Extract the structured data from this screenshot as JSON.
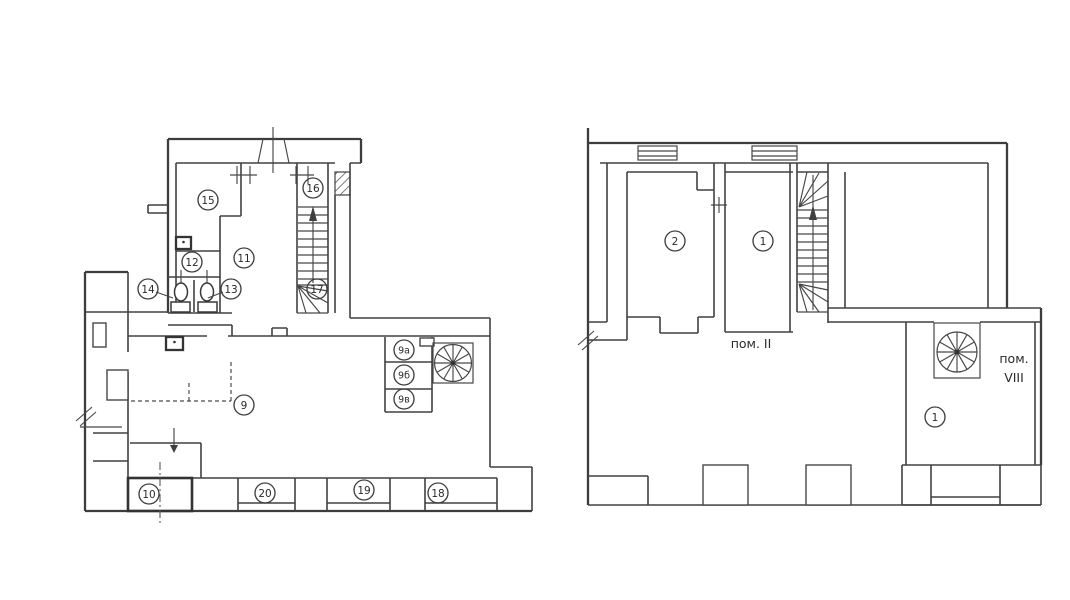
{
  "canvas": {
    "background": "#ffffff",
    "line_color": "#3f3f3f",
    "text_color": "#2b2b2b",
    "width_px": 1070,
    "height_px": 600
  },
  "left_plan": {
    "rooms": {
      "r15": "15",
      "r16": "16",
      "r11": "11",
      "r12": "12",
      "r14": "14",
      "r13": "13",
      "r17": "17",
      "r9": "9",
      "r9a": "9а",
      "r9b": "9б",
      "r9v": "9в",
      "r10": "10",
      "r20": "20",
      "r19": "19",
      "r18": "18"
    }
  },
  "right_plan": {
    "rooms": {
      "r2": "2",
      "r1_upper": "1",
      "r1_lower": "1"
    },
    "area_labels": {
      "pom_ii": "пом. II",
      "pom_viii_top": "пом.",
      "pom_viii_bottom": "VIII"
    }
  }
}
